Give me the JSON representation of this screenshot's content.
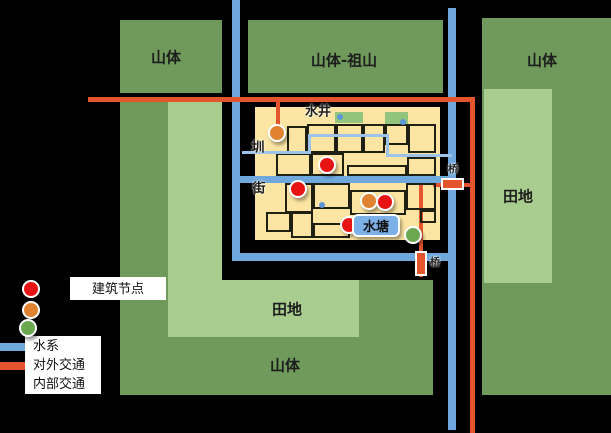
{
  "title": "村落选址格局示意图",
  "labels": {
    "mountain_top_left": "山体",
    "mountain_top_center": "山体-祖山",
    "mountain_top_right": "山体",
    "field_right": "田地",
    "field_bottom": "田地",
    "mountain_bottom": "山体",
    "well": "水井",
    "channel": "圳",
    "street": "街",
    "pond": "水塘",
    "bridge_right": "桥",
    "bridge_south": "桥"
  },
  "legend": {
    "node_items": [
      {
        "label": "建筑节点",
        "color": "#E81414"
      },
      {
        "label": "",
        "color": "#E08330"
      },
      {
        "label": "",
        "color": "#6BA84F"
      }
    ],
    "line_items": [
      {
        "label": "水系",
        "color": "#6FA8DC"
      },
      {
        "label": "对外交通",
        "color": "#E5552D"
      },
      {
        "label": "内部交通",
        "color": "#000000"
      }
    ]
  },
  "colors": {
    "mountain": "#6F9A5B",
    "field": "#A9CD8E",
    "village": "#FCE5A3",
    "plot_green": "#93C47D",
    "water": "#6FA8DC",
    "channel": "#9EC3EB",
    "road": "#E5552D",
    "node_red": "#E81414",
    "node_orange": "#E08330",
    "node_green": "#6BA84F",
    "pond_fill": "#7CB0E6",
    "building_outline": "#1f1f12"
  },
  "map": {
    "buildings": [
      [
        287,
        126,
        20,
        27
      ],
      [
        307,
        124,
        29,
        29
      ],
      [
        336,
        124,
        27,
        29
      ],
      [
        363,
        124,
        22,
        29
      ],
      [
        385,
        124,
        23,
        21
      ],
      [
        408,
        124,
        28,
        29
      ],
      [
        276,
        153,
        35,
        23
      ],
      [
        311,
        153,
        33,
        23
      ],
      [
        347,
        165,
        60,
        11
      ],
      [
        407,
        157,
        29,
        19
      ],
      [
        285,
        183,
        28,
        30
      ],
      [
        313,
        183,
        37,
        26
      ],
      [
        350,
        190,
        56,
        25
      ],
      [
        406,
        183,
        30,
        27
      ],
      [
        266,
        212,
        25,
        20
      ],
      [
        291,
        212,
        22,
        26
      ],
      [
        313,
        223,
        37,
        15
      ],
      [
        420,
        210,
        16,
        13
      ]
    ],
    "plots": [
      {
        "x": 335,
        "y": 112,
        "w": 28,
        "h": 11
      },
      {
        "x": 385,
        "y": 112,
        "w": 23,
        "h": 12
      }
    ],
    "water_points": [
      {
        "x": 340,
        "y": 117,
        "r": 3
      },
      {
        "x": 403,
        "y": 122,
        "r": 3
      },
      {
        "x": 322,
        "y": 205,
        "r": 3
      }
    ],
    "nodes": [
      {
        "type": "orange",
        "color": "#E08330",
        "x": 277,
        "y": 133
      },
      {
        "type": "red",
        "color": "#E81414",
        "x": 327,
        "y": 165
      },
      {
        "type": "red",
        "color": "#E81414",
        "x": 298,
        "y": 189
      },
      {
        "type": "orange",
        "color": "#E08330",
        "x": 369,
        "y": 201
      },
      {
        "type": "red",
        "color": "#E81414",
        "x": 385,
        "y": 202
      },
      {
        "type": "red",
        "color": "#E81414",
        "x": 349,
        "y": 225
      },
      {
        "type": "green",
        "color": "#6BA84F",
        "x": 413,
        "y": 235
      }
    ]
  }
}
